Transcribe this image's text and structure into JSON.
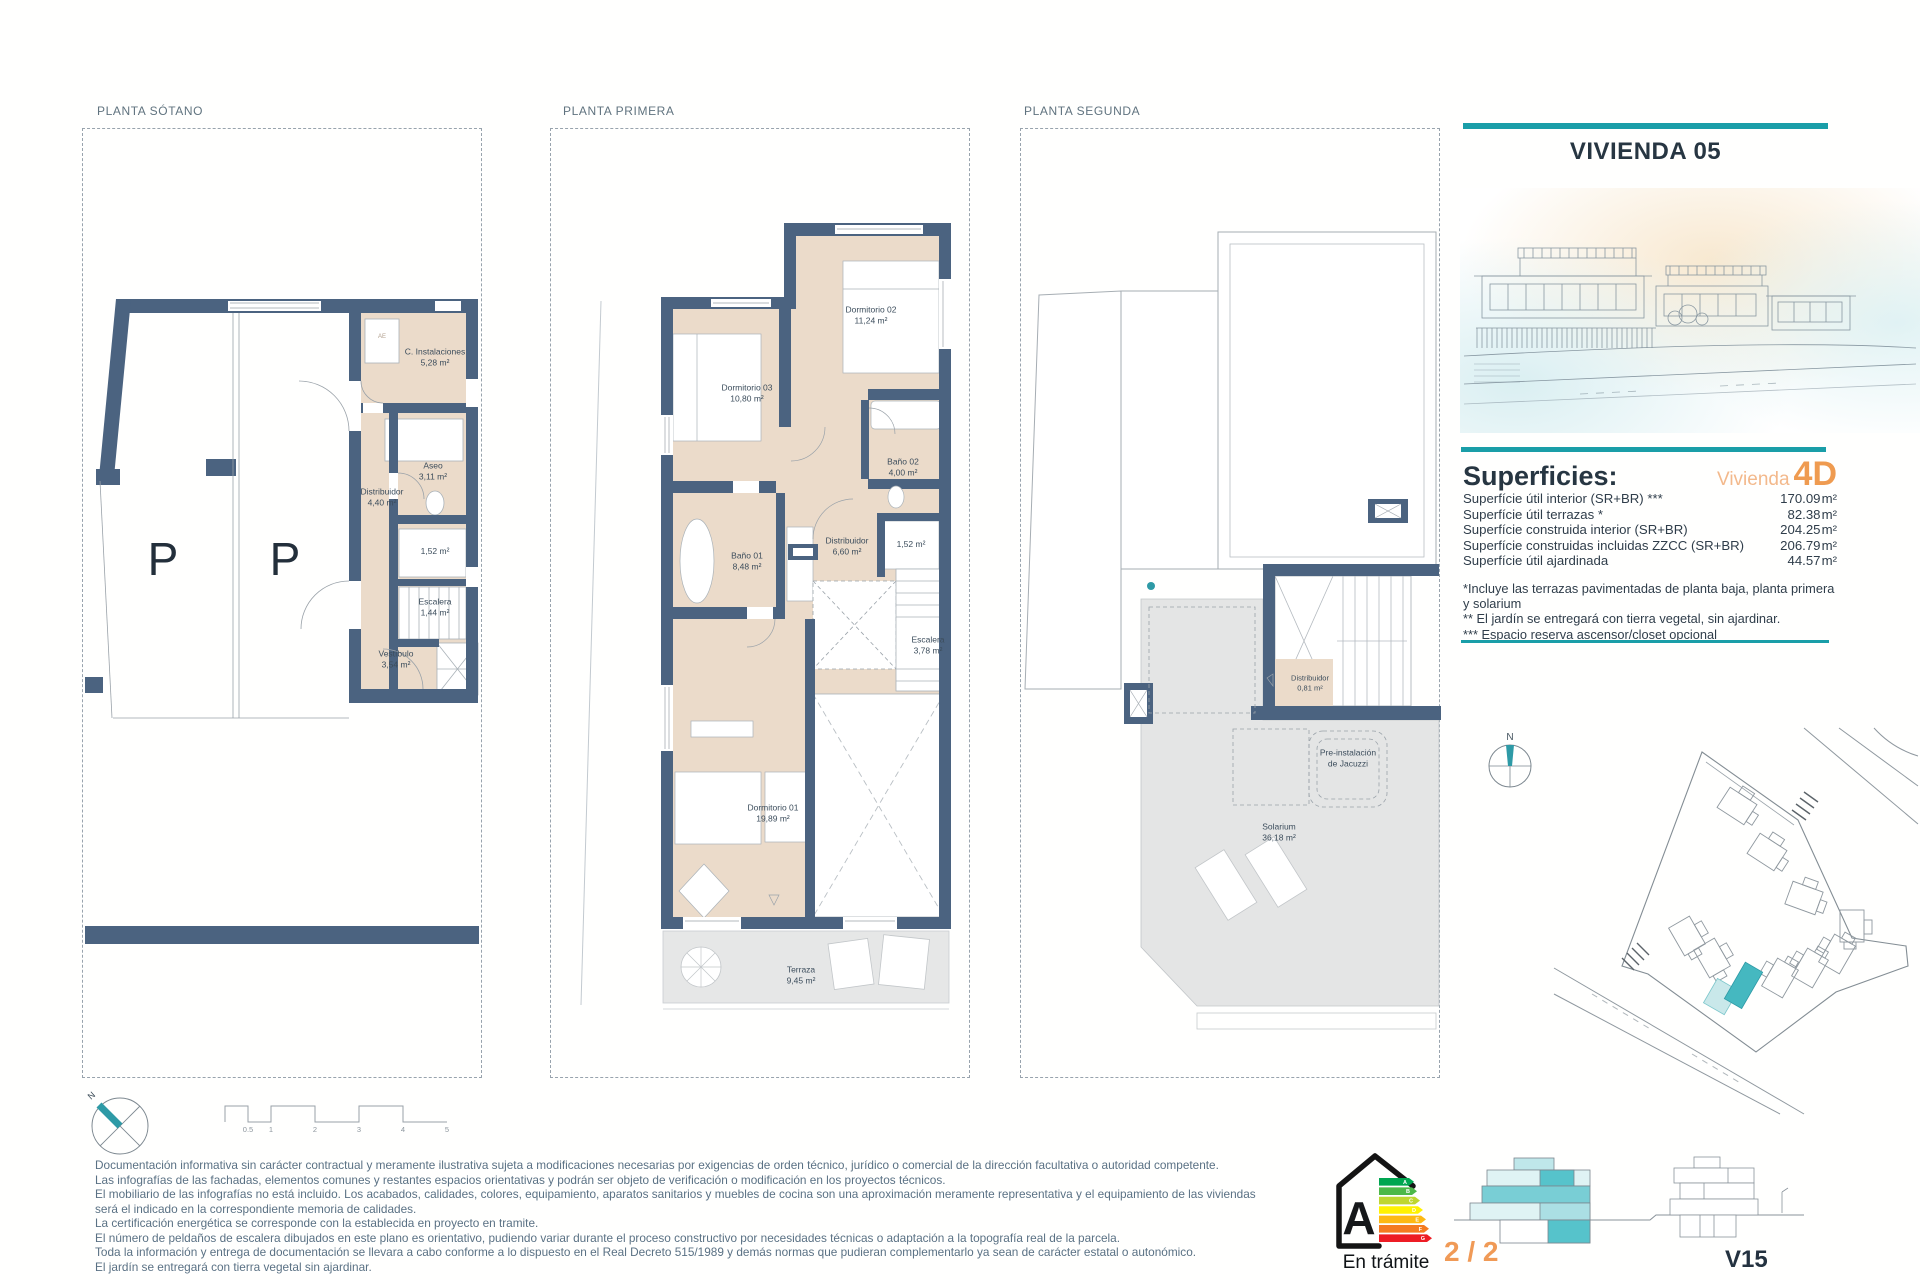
{
  "colors": {
    "teal_accent": "#1a9ea8",
    "orange_accent": "#f09a56",
    "orange_light": "#f3b98c",
    "wall_blue": "#4b6380",
    "floor_beige": "#ebdbca",
    "terrace_gray": "#e6e7e7",
    "map_highlight": "#45b8c0",
    "map_highlight_light": "#c9e8ea",
    "energy_scale_colors": [
      "#00a651",
      "#4cb848",
      "#bed630",
      "#fff200",
      "#fdb913",
      "#f47b20",
      "#ed1c24"
    ]
  },
  "plans": {
    "sotano": {
      "title": "PLANTA SÓTANO",
      "parking_mark": "P",
      "closet_mark": "AE",
      "rooms": [
        {
          "name": "C. Instalaciones",
          "area": "5,28 m²"
        },
        {
          "name": "Aseo",
          "area": "3,11 m²"
        },
        {
          "name": "Distribuidor",
          "area": "4,40 m²"
        },
        {
          "name": "",
          "area": "1,52 m²"
        },
        {
          "name": "Escalera",
          "area": "1,44 m²"
        },
        {
          "name": "Vestíbulo",
          "area": "3,54 m²"
        }
      ]
    },
    "primera": {
      "title": "PLANTA PRIMERA",
      "rooms": [
        {
          "name": "Dormitorio 02",
          "area": "11,24 m²"
        },
        {
          "name": "Dormitorio 03",
          "area": "10,80 m²"
        },
        {
          "name": "Baño 02",
          "area": "4,00 m²"
        },
        {
          "name": "Baño 01",
          "area": "8,48 m²"
        },
        {
          "name": "Distribuidor",
          "area": "6,60 m²"
        },
        {
          "name": "",
          "area": "1,52 m²"
        },
        {
          "name": "Escalera",
          "area": "3,78 m²"
        },
        {
          "name": "Dormitorio 01",
          "area": "19,89 m²"
        },
        {
          "name": "Terraza",
          "area": "9,45 m²"
        }
      ]
    },
    "segunda": {
      "title": "PLANTA SEGUNDA",
      "rooms": [
        {
          "name": "Distribuidor",
          "area": "0,81 m²"
        },
        {
          "name": "Pre-instalación",
          "area": "de Jacuzzi"
        },
        {
          "name": "Solarium",
          "area": "36,18 m²"
        }
      ]
    }
  },
  "panel": {
    "title": "VIVIENDA 05",
    "superficies": {
      "heading": "Superficies:",
      "unit_word": "Vivienda",
      "unit_type": "4D",
      "rows": [
        {
          "label": "Superfície útil interior (SR+BR) ***",
          "value": "170.09",
          "unit": "m²"
        },
        {
          "label": "Superfície útil terrazas *",
          "value": "82.38",
          "unit": "m²"
        },
        {
          "label": "Superfície construida interior (SR+BR)",
          "value": "204.25",
          "unit": "m²"
        },
        {
          "label": "Superfície construidas incluidas ZZCC (SR+BR)",
          "value": "206.79",
          "unit": "m²"
        },
        {
          "label": "Superfície útil ajardinada",
          "value": "44.57",
          "unit": "m²"
        }
      ],
      "notes": [
        "*Incluye las terrazas pavimentadas de planta baja, planta primera y solarium",
        "** El jardín se entregará con tierra vegetal, sin ajardinar.",
        "*** Espacio reserva ascensor/closet opcional"
      ]
    }
  },
  "compass": {
    "north": "N"
  },
  "scalebar": {
    "ticks": [
      "0.5",
      "1",
      "2",
      "3",
      "4",
      "5"
    ]
  },
  "footer": {
    "disclaimer": [
      "Documentación informativa sin carácter contractual y meramente ilustrativa sujeta a modificaciones necesarias por exigencias de orden técnico, jurídico o comercial de la dirección facultativa o autoridad competente.",
      "Las infografías de las fachadas, elementos comunes y restantes espacios orientativas y podrán ser objeto de verificación o modificación en los proyectos técnicos.",
      "El mobiliario de las infografías no está incluido. Los acabados, calidades, colores, equipamiento, aparatos sanitarios y muebles de cocina son una aproximación meramente representativa y el equipamiento de las viviendas será el indicado en la correspondiente memoria de calidades.",
      "La certificación energética se corresponde con la establecida en proyecto en tramite.",
      "El número de peldaños de escalera dibujados en este plano es orientativo, pudiendo variar durante el proceso constructivo por necesidades técnicas o adaptación a la topografía real de la parcela.",
      "Toda la información y entrega de documentación se llevara a cabo conforme a lo dispuesto en el Real Decreto 515/1989 y demás normas que pudieran complementarlo ya sean de carácter estatal o autonómico.",
      "El jardín se entregará con tierra vegetal sin ajardinar."
    ],
    "energy": {
      "grade": "A",
      "status": "En trámite",
      "scale": [
        "A",
        "B",
        "C",
        "D",
        "E",
        "F",
        "G"
      ]
    },
    "page": "2 / 2",
    "sheet": "V15"
  }
}
